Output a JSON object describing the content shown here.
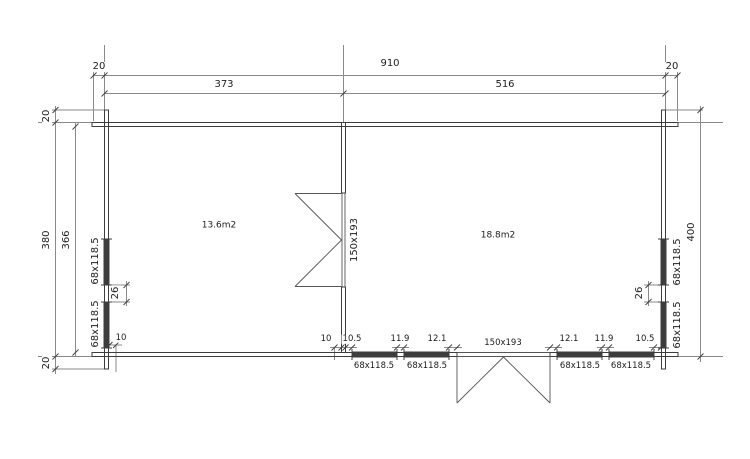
{
  "plan": {
    "rooms": [
      {
        "area_label": "13.6m2"
      },
      {
        "area_label": "18.8m2"
      }
    ],
    "interior_door_label": "150x193",
    "entrance_door_label": "150x193"
  },
  "dim_top": {
    "left_overhang": "20",
    "overall": "910",
    "right_overhang": "20",
    "room1": "373",
    "room2": "516"
  },
  "dim_left": {
    "top_overhang": "20",
    "overall": "380",
    "inner": "366",
    "bottom_overhang": "20",
    "win_upper": "68x118.5",
    "win_gap": "26",
    "win_lower": "68x118.5",
    "corner_offset": "10"
  },
  "dim_right": {
    "overall": "400",
    "win_upper": "68x118.5",
    "win_gap": "26",
    "win_lower": "68x118.5"
  },
  "dim_bottom": {
    "divider_left": "10",
    "divider_right": "10.5",
    "gap2": "11.9",
    "gap3": "12.1",
    "gap4": "12.1",
    "gap5": "11.9",
    "gap6": "10.5",
    "win_labels": [
      "68x118.5",
      "68x118.5",
      "68x118.5",
      "68x118.5"
    ]
  }
}
